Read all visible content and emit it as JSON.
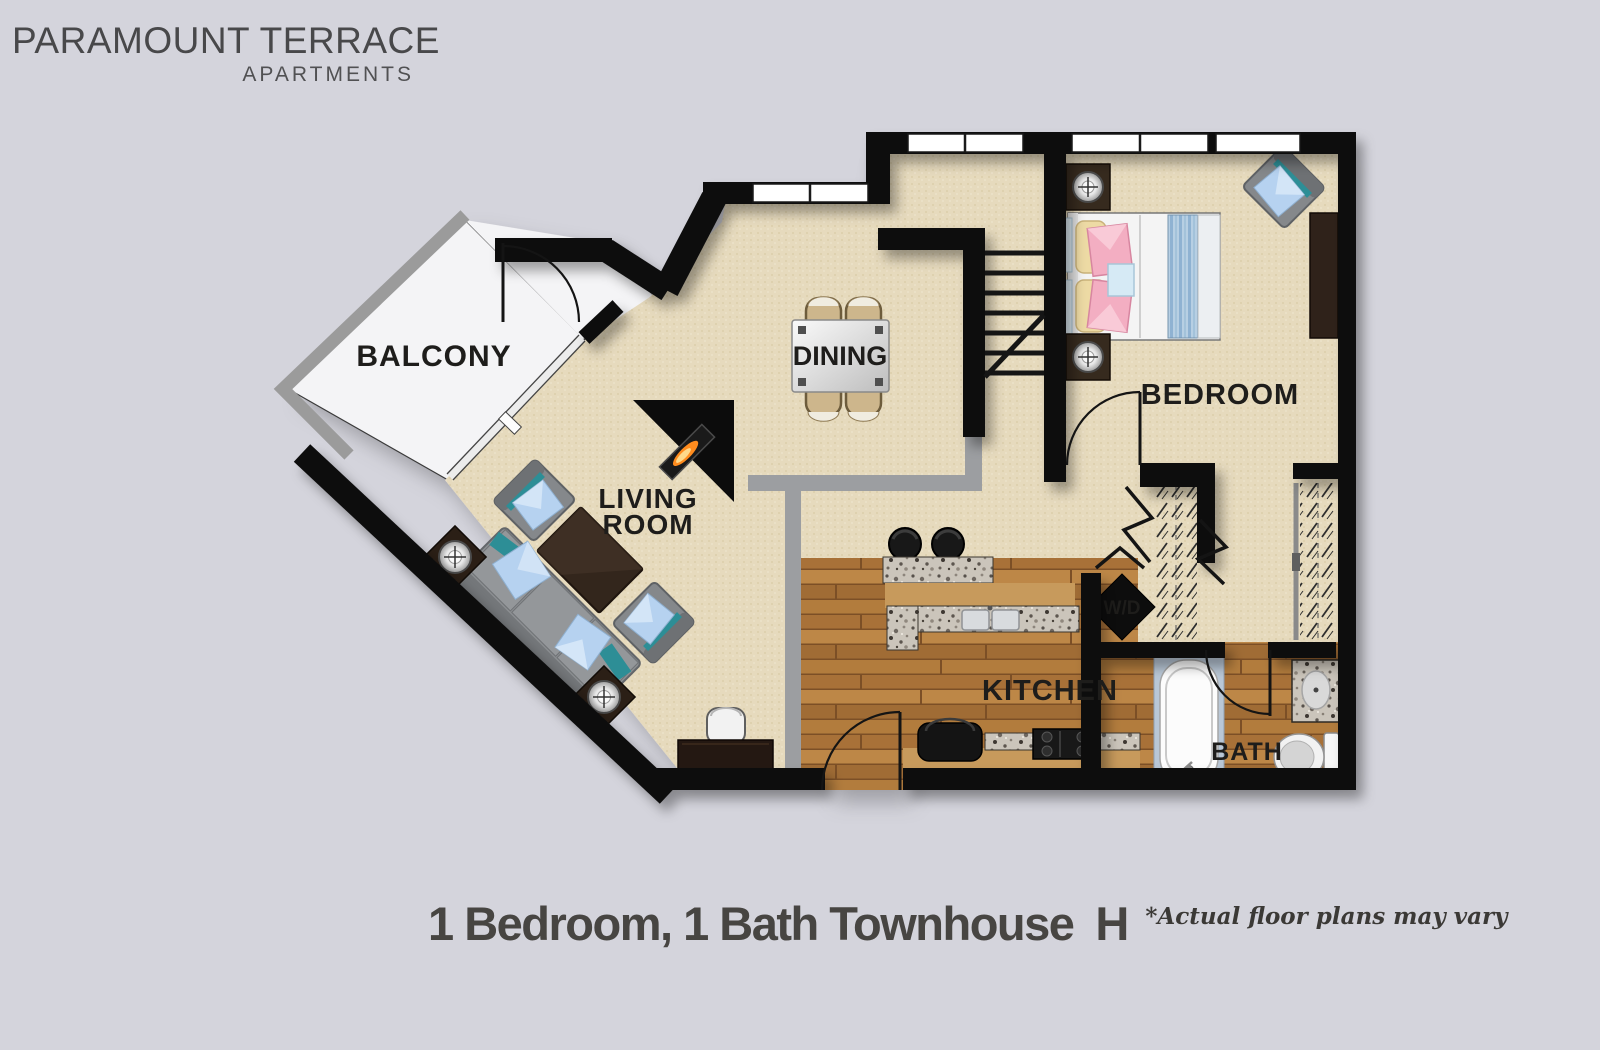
{
  "logo": {
    "line1": "PARAMOUNT TERRACE",
    "line2": "APARTMENTS"
  },
  "caption": {
    "title": "1 Bedroom, 1 Bath Townhouse",
    "plan_letter": "H",
    "disclaimer": "*Actual floor plans may vary"
  },
  "rooms": {
    "balcony": "BALCONY",
    "dining": "DINING",
    "living_line1": "LIVING",
    "living_line2": "ROOM",
    "bedroom": "BEDROOM",
    "kitchen": "KITCHEN",
    "bath": "BATH",
    "washer_dryer": "W/D"
  },
  "colors": {
    "background": "#d4d4dc",
    "wall": "#101010",
    "carpet": "#e6dabd",
    "wood": "#b5803f",
    "balcony_floor": "#f4f4f6",
    "railing": "#9b9b9b",
    "half_wall": "#9c9ea1",
    "accent_teal": "#2d8e96",
    "pillow_blue": "#b6d2f0",
    "granite": "#cbc5bb",
    "counter_tan": "#c79a5c",
    "label_text": "#1e1d1b"
  }
}
